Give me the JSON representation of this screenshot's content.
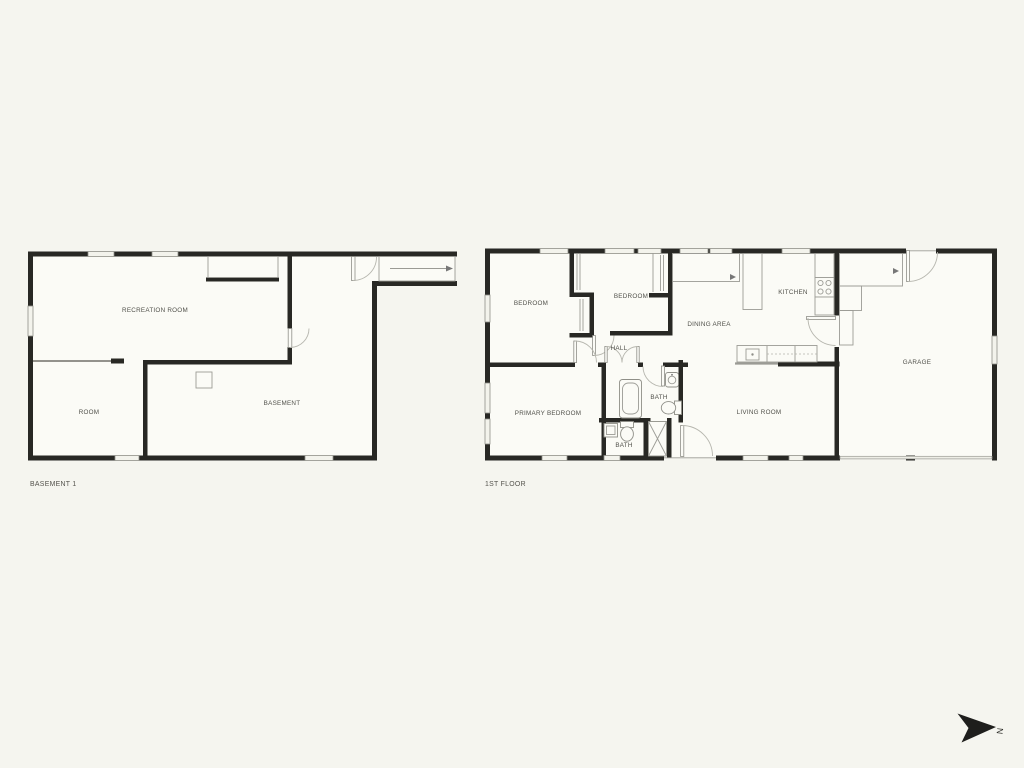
{
  "page": {
    "background_color": "#f5f5ef"
  },
  "colors": {
    "wall": "#282824",
    "window_fill": "#f3f3ec",
    "line": "#9b9b95",
    "label": "#50504a",
    "interior": "#fbfbf6",
    "north": "#1e1e1c"
  },
  "north_indicator": {
    "label": "N"
  },
  "floors": [
    {
      "title": "BASEMENT 1",
      "rooms": [
        {
          "label": "RECREATION ROOM",
          "x": 155,
          "y": 312
        },
        {
          "label": "ROOM",
          "x": 89,
          "y": 414
        },
        {
          "label": "BASEMENT",
          "x": 282,
          "y": 405
        }
      ]
    },
    {
      "title": "1ST FLOOR",
      "rooms": [
        {
          "label": "BEDROOM",
          "x": 531,
          "y": 305
        },
        {
          "label": "BEDROOM",
          "x": 631,
          "y": 298
        },
        {
          "label": "KITCHEN",
          "x": 793,
          "y": 294
        },
        {
          "label": "DINING AREA",
          "x": 709,
          "y": 326
        },
        {
          "label": "HALL",
          "x": 619,
          "y": 350
        },
        {
          "label": "BATH",
          "x": 659,
          "y": 399
        },
        {
          "label": "PRIMARY BEDROOM",
          "x": 548,
          "y": 415
        },
        {
          "label": "BATH",
          "x": 624,
          "y": 447
        },
        {
          "label": "LIVING ROOM",
          "x": 759,
          "y": 414
        },
        {
          "label": "GARAGE",
          "x": 917,
          "y": 364
        }
      ]
    }
  ]
}
